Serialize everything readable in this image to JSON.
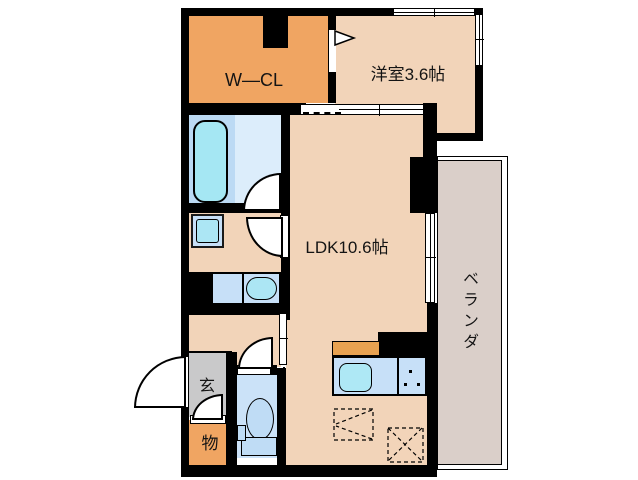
{
  "plan_title": "1LDK floor plan",
  "rooms": {
    "wcl": "W—CL",
    "western": "洋室3.6帖",
    "ldk": "LDK10.6帖",
    "veranda": "ベランダ",
    "entrance": "玄",
    "storage": "物"
  },
  "colors": {
    "wall_black": "#000000",
    "closet_orange": "#F0A562",
    "floor_peach": "#F2D4B9",
    "bath_zone_blue": "#BCDAF4",
    "bath_floor_blue": "#DCEDFB",
    "fixture_panel_blue": "#C7E0F8",
    "fixture_cyan": "#A8E6F4",
    "toilet_room_blue": "#CBE2F8",
    "genkan_gray": "#C9C9CA",
    "veranda_gray": "#DACFC9",
    "counter_orange": "#E8A251"
  }
}
